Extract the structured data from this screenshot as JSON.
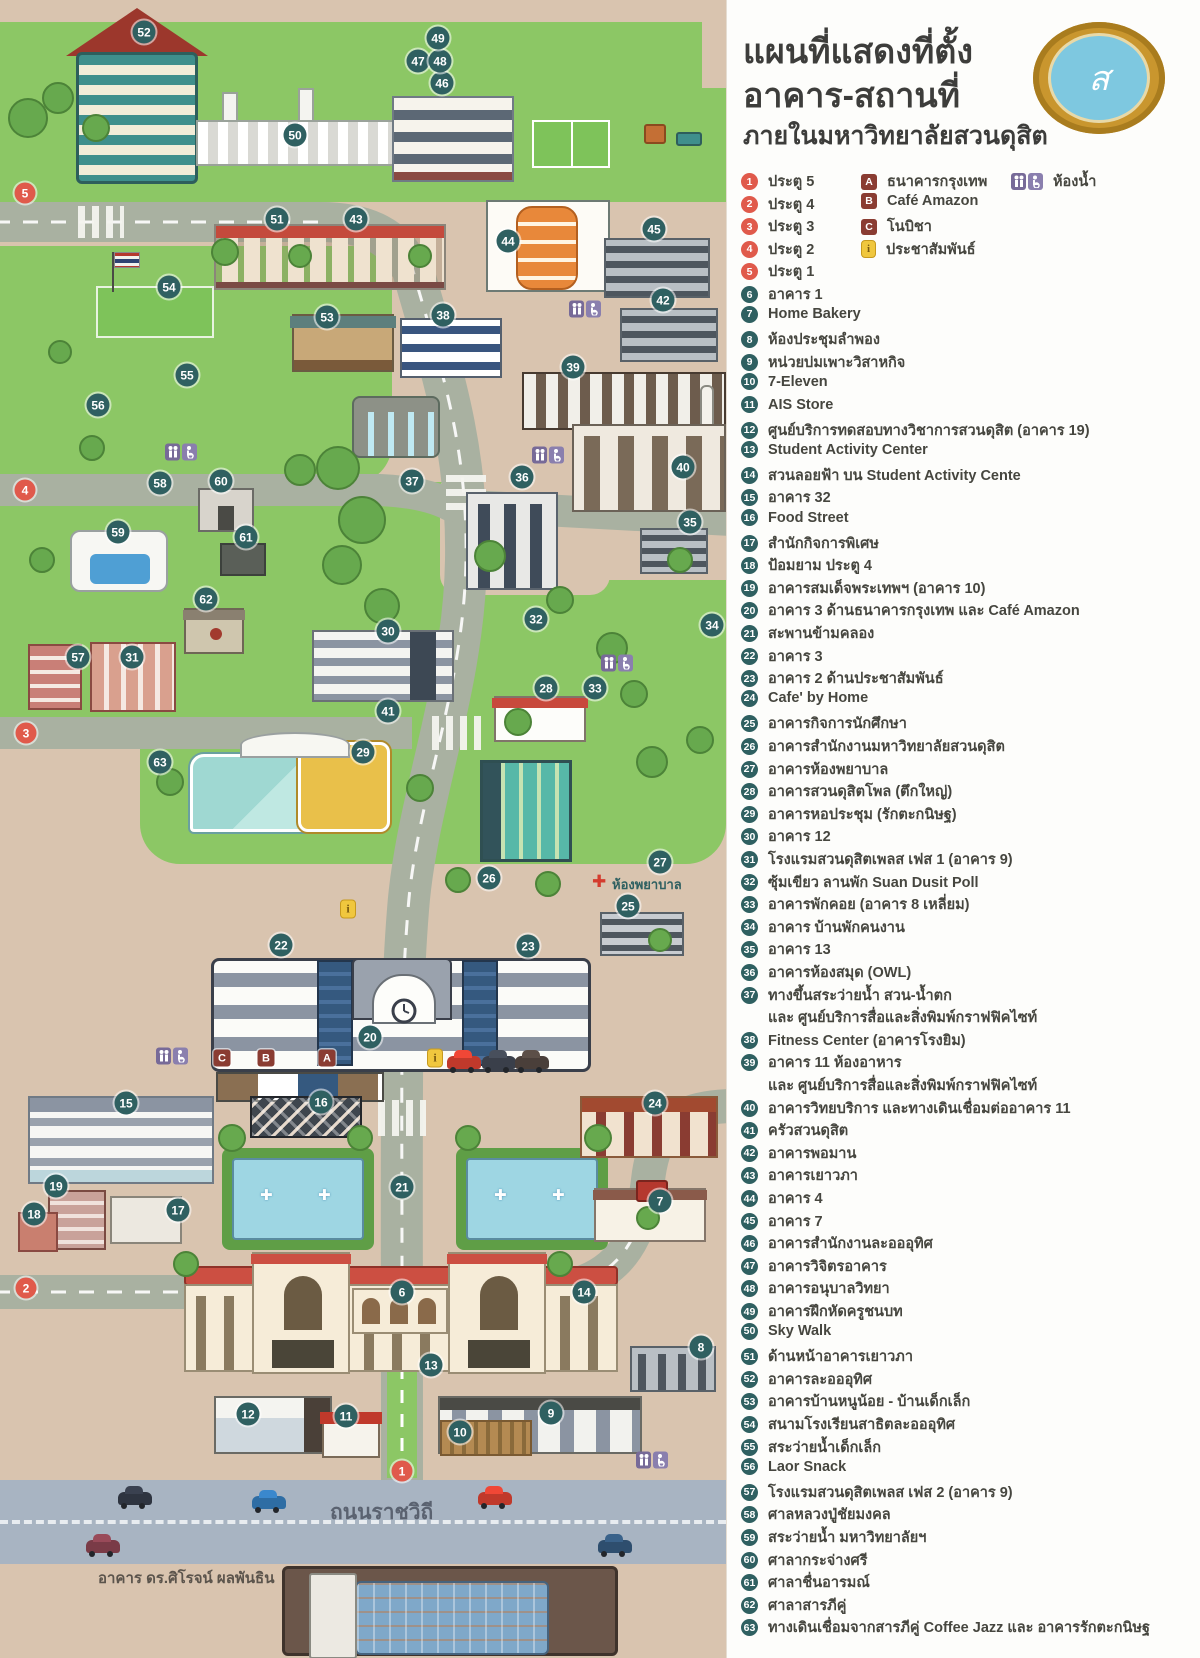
{
  "title": {
    "line1": "แผนที่แสดงที่ตั้ง",
    "line2": "อาคาร-สถานที่",
    "line3": "ภายในมหาวิทยาลัยสวนดุสิต"
  },
  "legend": {
    "gates": [
      {
        "num": "1",
        "label": "ประตู 5"
      },
      {
        "num": "2",
        "label": "ประตู 4"
      },
      {
        "num": "3",
        "label": "ประตู 3"
      },
      {
        "num": "4",
        "label": "ประตู 2"
      },
      {
        "num": "5",
        "label": "ประตู 1"
      }
    ],
    "special": [
      {
        "key": "A",
        "label": "ธนาคารกรุงเทพ"
      },
      {
        "key": "B",
        "label": "Café Amazon"
      },
      {
        "key": "C",
        "label": "โนบิชา"
      },
      {
        "key": "i",
        "label": "ประชาสัมพันธ์"
      },
      {
        "key": "wc",
        "label": "ห้องน้ำ"
      }
    ],
    "items": [
      {
        "num": "6",
        "label": "อาคาร 1"
      },
      {
        "num": "7",
        "label": "Home Bakery"
      },
      {
        "num": "8",
        "label": "ห้องประชุมลำพอง"
      },
      {
        "num": "9",
        "label": "หน่วยบ่มเพาะวิสาหกิจ"
      },
      {
        "num": "10",
        "label": "7-Eleven"
      },
      {
        "num": "11",
        "label": "AIS Store"
      },
      {
        "num": "12",
        "label": "ศูนย์บริการทดสอบทางวิชาการสวนดุสิต (อาคาร 19)"
      },
      {
        "num": "13",
        "label": "Student Activity Center"
      },
      {
        "num": "14",
        "label": "สวนลอยฟ้า บน Student Activity Cente"
      },
      {
        "num": "15",
        "label": "อาคาร 32"
      },
      {
        "num": "16",
        "label": "Food Street"
      },
      {
        "num": "17",
        "label": "สำนักกิจการพิเศษ"
      },
      {
        "num": "18",
        "label": "ป้อมยาม ประตู 4"
      },
      {
        "num": "19",
        "label": "อาคารสมเด็จพระเทพฯ (อาคาร 10)"
      },
      {
        "num": "20",
        "label": "อาคาร 3 ด้านธนาคารกรุงเทพ และ Café Amazon"
      },
      {
        "num": "21",
        "label": "สะพานข้ามคลอง"
      },
      {
        "num": "22",
        "label": "อาคาร 3"
      },
      {
        "num": "23",
        "label": "อาคาร 2 ด้านประชาสัมพันธ์"
      },
      {
        "num": "24",
        "label": "Cafe' by Home"
      },
      {
        "num": "25",
        "label": "อาคารกิจการนักศึกษา"
      },
      {
        "num": "26",
        "label": "อาคารสำนักงานมหาวิทยาลัยสวนดุสิต"
      },
      {
        "num": "27",
        "label": "อาคารห้องพยาบาล"
      },
      {
        "num": "28",
        "label": "อาคารสวนดุสิตโพล (ตึกใหญ่)"
      },
      {
        "num": "29",
        "label": "อาคารหอประชุม (รักตะกนิษฐ)"
      },
      {
        "num": "30",
        "label": "อาคาร 12"
      },
      {
        "num": "31",
        "label": "โรงแรมสวนดุสิตเพลส เฟส 1 (อาคาร 9)"
      },
      {
        "num": "32",
        "label": "ซุ้มเขียว ลานพัก Suan Dusit Poll"
      },
      {
        "num": "33",
        "label": "อาคารพักคอย (อาคาร 8 เหลี่ยม)"
      },
      {
        "num": "34",
        "label": "อาคาร บ้านพักคนงาน"
      },
      {
        "num": "35",
        "label": "อาคาร 13"
      },
      {
        "num": "36",
        "label": "อาคารห้องสมุด (OWL)"
      },
      {
        "num": "37",
        "label": "ทางขึ้นสระว่ายน้ำ สวน-น้ำตก",
        "label2": "และ ศูนย์บริการสื่อและสิ่งพิมพ์กราฟฟิคไซท์"
      },
      {
        "num": "38",
        "label": "Fitness Center (อาคารโรงยิม)"
      },
      {
        "num": "39",
        "label": "อาคาร 11 ห้องอาหาร",
        "label2": "และ ศูนย์บริการสื่อและสิ่งพิมพ์กราฟฟิคไซท์"
      },
      {
        "num": "40",
        "label": "อาคารวิทยบริการ และทางเดินเชื่อมต่ออาคาร 11"
      },
      {
        "num": "41",
        "label": "ครัวสวนดุสิต"
      },
      {
        "num": "42",
        "label": "อาคารพอมาน"
      },
      {
        "num": "43",
        "label": "อาคารเยาวภา"
      },
      {
        "num": "44",
        "label": "อาคาร 4"
      },
      {
        "num": "45",
        "label": "อาคาร 7"
      },
      {
        "num": "46",
        "label": "อาคารสำนักงานละอออุทิศ"
      },
      {
        "num": "47",
        "label": "อาคารวิจิตรอาคาร"
      },
      {
        "num": "48",
        "label": "อาคารอนุบาลวิทยา"
      },
      {
        "num": "49",
        "label": "อาคารฝึกหัดครูชนบท"
      },
      {
        "num": "50",
        "label": "Sky Walk"
      },
      {
        "num": "51",
        "label": "ด้านหน้าอาคารเยาวภา"
      },
      {
        "num": "52",
        "label": "อาคารละอออุทิศ"
      },
      {
        "num": "53",
        "label": "อาคารบ้านหนูน้อย - บ้านเด็กเล็ก"
      },
      {
        "num": "54",
        "label": "สนามโรงเรียนสาธิตละอออุทิศ"
      },
      {
        "num": "55",
        "label": "สระว่ายน้ำเด็กเล็ก"
      },
      {
        "num": "56",
        "label": "Laor Snack"
      },
      {
        "num": "57",
        "label": "โรงแรมสวนดุสิตเพลส เฟส 2 (อาคาร 9)"
      },
      {
        "num": "58",
        "label": "ศาลหลวงปู่ชัยมงคล"
      },
      {
        "num": "59",
        "label": "สระว่ายน้ำ มหาวิทยาลัยฯ"
      },
      {
        "num": "60",
        "label": "ศาลากระจ่างศรี"
      },
      {
        "num": "61",
        "label": "ศาลาชื่นอารมณ์"
      },
      {
        "num": "62",
        "label": "ศาลาสารภีคู่"
      },
      {
        "num": "63",
        "label": "ทางเดินเชื่อมจากสารภีคู่ Coffee Jazz และ อาคารรักตะกนิษฐ"
      }
    ]
  },
  "map": {
    "road_label": "ถนนราชวิถี",
    "building_label": "อาคาร ดร.ศิโรจน์ ผลพันธิน",
    "nurse_label": "ห้องพยาบาล",
    "colors": {
      "badge_teal": "#2f6061",
      "gate_red": "#e05a4b",
      "green": "#8cc765",
      "beige": "#d9c4af",
      "road": "#a9b1a1",
      "ratchawithi_road": "#a8b4c2",
      "legend_square_red": "#8a3c32",
      "info_yellow": "#f0c73e",
      "restroom_purple": "#776a98"
    },
    "gate_markers": [
      {
        "num": "5",
        "x": 25,
        "y": 193
      },
      {
        "num": "4",
        "x": 25,
        "y": 490
      },
      {
        "num": "3",
        "x": 26,
        "y": 733
      },
      {
        "num": "2",
        "x": 26,
        "y": 1288
      },
      {
        "num": "1",
        "x": 402,
        "y": 1471
      }
    ],
    "markers": [
      {
        "num": "6",
        "x": 402,
        "y": 1292
      },
      {
        "num": "7",
        "x": 660,
        "y": 1201
      },
      {
        "num": "8",
        "x": 701,
        "y": 1347
      },
      {
        "num": "9",
        "x": 551,
        "y": 1413
      },
      {
        "num": "10",
        "x": 460,
        "y": 1432
      },
      {
        "num": "11",
        "x": 346,
        "y": 1416
      },
      {
        "num": "12",
        "x": 248,
        "y": 1414
      },
      {
        "num": "13",
        "x": 431,
        "y": 1365
      },
      {
        "num": "14",
        "x": 584,
        "y": 1292
      },
      {
        "num": "15",
        "x": 126,
        "y": 1103
      },
      {
        "num": "16",
        "x": 321,
        "y": 1102
      },
      {
        "num": "17",
        "x": 178,
        "y": 1210
      },
      {
        "num": "18",
        "x": 34,
        "y": 1214
      },
      {
        "num": "19",
        "x": 56,
        "y": 1186
      },
      {
        "num": "20",
        "x": 370,
        "y": 1037
      },
      {
        "num": "21",
        "x": 402,
        "y": 1187
      },
      {
        "num": "22",
        "x": 281,
        "y": 945
      },
      {
        "num": "23",
        "x": 528,
        "y": 946
      },
      {
        "num": "24",
        "x": 655,
        "y": 1103
      },
      {
        "num": "25",
        "x": 628,
        "y": 906
      },
      {
        "num": "26",
        "x": 489,
        "y": 878
      },
      {
        "num": "27",
        "x": 660,
        "y": 862
      },
      {
        "num": "28",
        "x": 546,
        "y": 688
      },
      {
        "num": "29",
        "x": 363,
        "y": 752
      },
      {
        "num": "30",
        "x": 388,
        "y": 631
      },
      {
        "num": "31",
        "x": 132,
        "y": 657
      },
      {
        "num": "32",
        "x": 536,
        "y": 619
      },
      {
        "num": "33",
        "x": 595,
        "y": 688
      },
      {
        "num": "34",
        "x": 712,
        "y": 625
      },
      {
        "num": "35",
        "x": 690,
        "y": 522
      },
      {
        "num": "36",
        "x": 522,
        "y": 477
      },
      {
        "num": "37",
        "x": 412,
        "y": 481
      },
      {
        "num": "38",
        "x": 443,
        "y": 315
      },
      {
        "num": "39",
        "x": 573,
        "y": 367
      },
      {
        "num": "40",
        "x": 683,
        "y": 467
      },
      {
        "num": "41",
        "x": 388,
        "y": 711
      },
      {
        "num": "42",
        "x": 663,
        "y": 300
      },
      {
        "num": "43",
        "x": 356,
        "y": 219
      },
      {
        "num": "44",
        "x": 508,
        "y": 241
      },
      {
        "num": "45",
        "x": 654,
        "y": 229
      },
      {
        "num": "46",
        "x": 442,
        "y": 83
      },
      {
        "num": "47",
        "x": 418,
        "y": 61
      },
      {
        "num": "48",
        "x": 440,
        "y": 61
      },
      {
        "num": "49",
        "x": 438,
        "y": 38
      },
      {
        "num": "50",
        "x": 295,
        "y": 135
      },
      {
        "num": "51",
        "x": 277,
        "y": 219
      },
      {
        "num": "52",
        "x": 144,
        "y": 32
      },
      {
        "num": "53",
        "x": 327,
        "y": 317
      },
      {
        "num": "54",
        "x": 169,
        "y": 287
      },
      {
        "num": "55",
        "x": 187,
        "y": 375
      },
      {
        "num": "56",
        "x": 98,
        "y": 405
      },
      {
        "num": "57",
        "x": 78,
        "y": 657
      },
      {
        "num": "58",
        "x": 160,
        "y": 483
      },
      {
        "num": "59",
        "x": 118,
        "y": 532
      },
      {
        "num": "60",
        "x": 221,
        "y": 481
      },
      {
        "num": "61",
        "x": 246,
        "y": 537
      },
      {
        "num": "62",
        "x": 206,
        "y": 599
      },
      {
        "num": "63",
        "x": 160,
        "y": 762
      }
    ],
    "letter_markers": [
      {
        "key": "A",
        "x": 327,
        "y": 1058
      },
      {
        "key": "B",
        "x": 266,
        "y": 1058
      },
      {
        "key": "C",
        "x": 222,
        "y": 1058
      }
    ],
    "info_markers": [
      {
        "x": 348,
        "y": 909
      },
      {
        "x": 435,
        "y": 1058
      }
    ],
    "restroom_markers": [
      {
        "x": 585,
        "y": 309
      },
      {
        "x": 181,
        "y": 452
      },
      {
        "x": 548,
        "y": 455
      },
      {
        "x": 617,
        "y": 663
      },
      {
        "x": 172,
        "y": 1056
      },
      {
        "x": 652,
        "y": 1460
      }
    ],
    "trees": [
      [
        28,
        118,
        20
      ],
      [
        58,
        98,
        16
      ],
      [
        96,
        128,
        14
      ],
      [
        225,
        252,
        14
      ],
      [
        300,
        256,
        12
      ],
      [
        420,
        256,
        12
      ],
      [
        338,
        468,
        22
      ],
      [
        362,
        520,
        24
      ],
      [
        342,
        565,
        20
      ],
      [
        382,
        606,
        18
      ],
      [
        300,
        470,
        16
      ],
      [
        490,
        556,
        16
      ],
      [
        560,
        600,
        14
      ],
      [
        612,
        648,
        16
      ],
      [
        634,
        694,
        14
      ],
      [
        518,
        722,
        14
      ],
      [
        652,
        762,
        16
      ],
      [
        170,
        782,
        14
      ],
      [
        420,
        788,
        14
      ],
      [
        458,
        880,
        13
      ],
      [
        548,
        884,
        13
      ],
      [
        232,
        1138,
        14
      ],
      [
        360,
        1138,
        13
      ],
      [
        468,
        1138,
        13
      ],
      [
        598,
        1138,
        14
      ],
      [
        186,
        1264,
        13
      ],
      [
        560,
        1264,
        13
      ],
      [
        648,
        1218,
        12
      ],
      [
        92,
        448,
        13
      ],
      [
        42,
        560,
        13
      ],
      [
        60,
        352,
        12
      ],
      [
        680,
        560,
        13
      ],
      [
        700,
        740,
        14
      ],
      [
        660,
        940,
        12
      ]
    ],
    "cars": [
      {
        "x": 118,
        "y": 1492,
        "c": "#2e3440"
      },
      {
        "x": 252,
        "y": 1496,
        "c": "#2e6da4"
      },
      {
        "x": 478,
        "y": 1492,
        "c": "#c0392b"
      },
      {
        "x": 86,
        "y": 1540,
        "c": "#7a3b47"
      },
      {
        "x": 598,
        "y": 1540,
        "c": "#2e4e6e"
      },
      {
        "x": 447,
        "y": 1056,
        "c": "#c0392b"
      },
      {
        "x": 482,
        "y": 1056,
        "c": "#3a3f4a"
      },
      {
        "x": 515,
        "y": 1056,
        "c": "#4a3f3a"
      }
    ]
  }
}
